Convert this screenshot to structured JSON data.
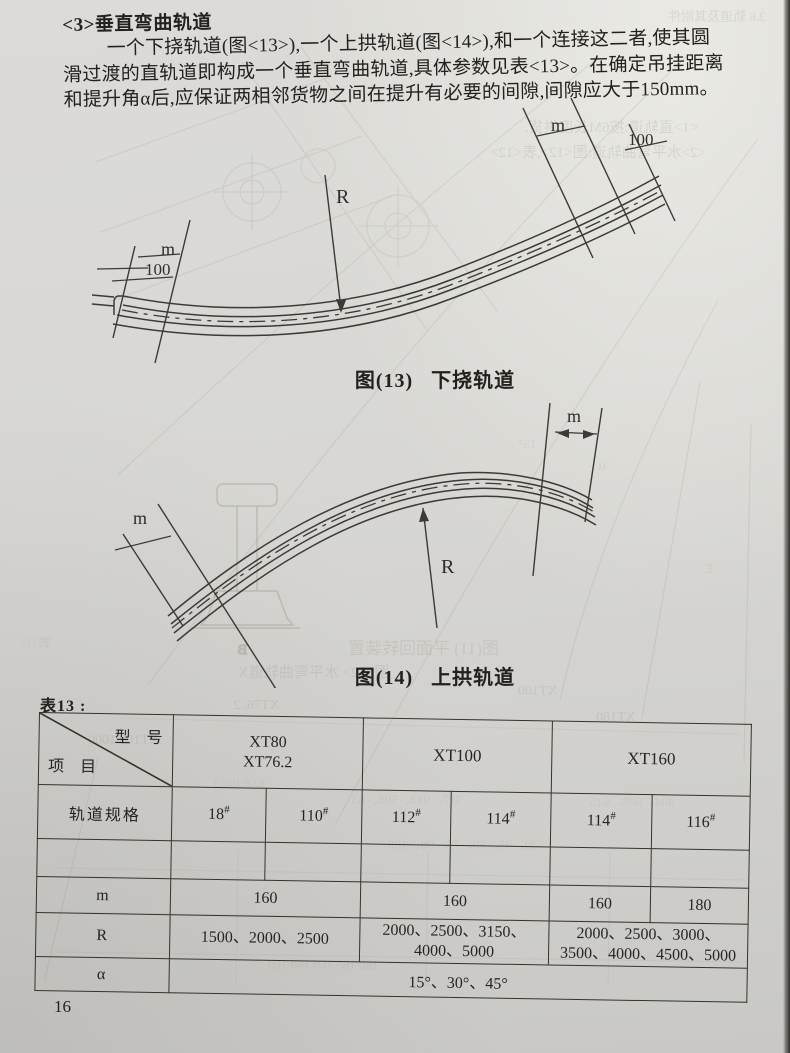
{
  "doc": {
    "heading": "<3>垂直弯曲轨道",
    "para": [
      "一个下挠轨道(图<13>),一个上拱轨道(图<14>),和一个连接这二者,使其圆",
      "滑过渡的直轨道即构成一个垂直弯曲轨道,具体参数见表<13>。在确定吊挂距离",
      "和提升角α后,应保证两相邻货物之间在提升有必要的间隙,间隙应大于150mm。"
    ],
    "page_number": "16"
  },
  "fig13": {
    "caption": "图(13)   下挠轨道",
    "label_r": "R",
    "label_m_left": "m",
    "label_100_left": "100",
    "label_m_right": "m",
    "label_100_right": "100"
  },
  "fig14": {
    "caption": "图(14)   上拱轨道",
    "label_r": "R",
    "label_m_left": "m",
    "label_m_right": "m",
    "label_b_ghost": "B"
  },
  "table13": {
    "title": "表13 :",
    "corner_top": "型　号",
    "corner_bottom": "项　目",
    "groups": [
      {
        "l1": "XT80",
        "l2": "XT76.2"
      },
      {
        "l1": "XT100"
      },
      {
        "l1": "XT160"
      }
    ],
    "spec": {
      "label": "轨道规格",
      "cells": [
        {
          "n": "18",
          "s": "#"
        },
        {
          "n": "110",
          "s": "#"
        },
        {
          "n": "112",
          "s": "#"
        },
        {
          "n": "114",
          "s": "#"
        },
        {
          "n": "114",
          "s": "#"
        },
        {
          "n": "116",
          "s": "#"
        }
      ]
    },
    "m": {
      "label": "m",
      "cells": [
        "160",
        "160",
        "160",
        "180"
      ]
    },
    "r": {
      "label": "R",
      "cells": [
        "1500、2000、2500",
        "2000、2500、3150、\n4000、5000",
        "2000、2500、3000、\n3500、4000、4500、5000"
      ]
    },
    "alpha": {
      "label": "α",
      "value": "15°、30°、45°"
    }
  },
  "ghosts": [
    {
      "text": "3.6 轨道及其附件"
    },
    {
      "text": "<1>直轨道:按6M长度供货."
    },
    {
      "text": "<2>水平弯曲轨道:图<12>,表<12>"
    },
    {
      "text": "15°"
    },
    {
      "text": "α"
    },
    {
      "text": "E"
    },
    {
      "text": "图(11) 平面回转装置"
    },
    {
      "text": "图<12> 水平弯曲轨道X"
    },
    {
      "text": "XT100"
    },
    {
      "text": "XT76. 2"
    },
    {
      "text": "XT160    1000"
    },
    {
      "text": "XT180"
    },
    {
      "text": "62.8   100.3"
    },
    {
      "text": "317、913、508、63"
    },
    {
      "text": "404、508、615"
    },
    {
      "text": "30、45、60、75、90、180"
    },
    {
      "text": "160      160      160      160      160"
    },
    {
      "text": "表11:"
    }
  ]
}
